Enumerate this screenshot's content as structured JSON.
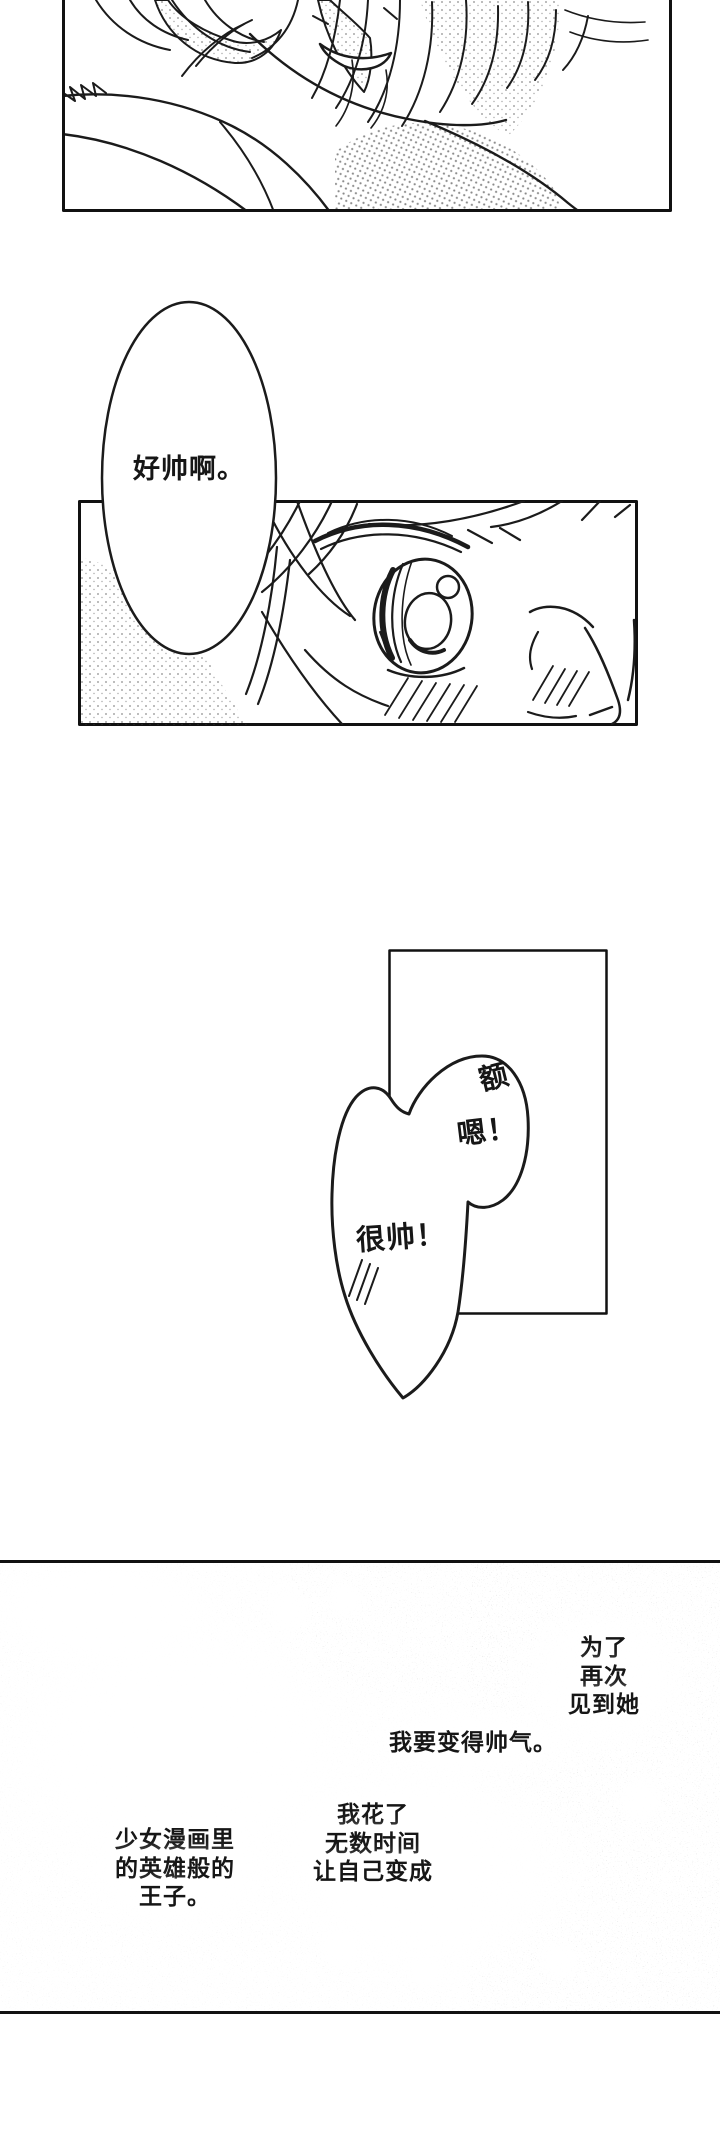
{
  "page": {
    "paper_color": "#ffffff",
    "ink_color": "#1b1b1b"
  },
  "speech": {
    "admire": {
      "text": "好帅啊。"
    },
    "stammer": {
      "word_top": "额",
      "word_mid": "嗯！",
      "word_bottom": "很帅！"
    }
  },
  "narration": {
    "goal_lines": [
      "为了",
      "再次",
      "见到她"
    ],
    "resolve_text": "我要变得帅气。",
    "effort_lines": [
      "我花了",
      "无数时间",
      "让自己变成"
    ],
    "prince_lines": [
      "少女漫画里",
      "的英雄般的",
      "王子。"
    ]
  }
}
